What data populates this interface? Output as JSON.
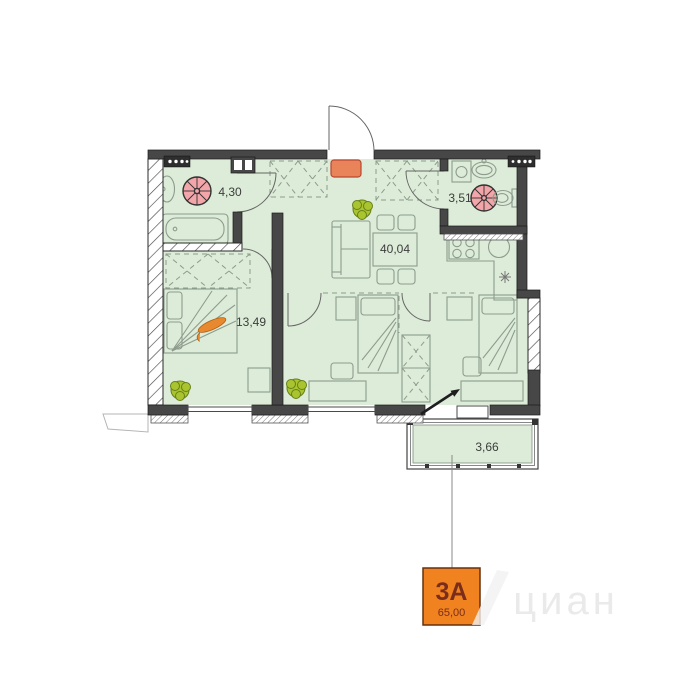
{
  "plan": {
    "unit": {
      "label": "3А",
      "area": "65,00"
    },
    "rooms": [
      {
        "id": "bathroom",
        "area": "4,30"
      },
      {
        "id": "wc",
        "area": "3,51"
      },
      {
        "id": "living-kitchen",
        "area": "40,04"
      },
      {
        "id": "bedroom",
        "area": "13,49"
      },
      {
        "id": "balcony",
        "area": "3,66"
      }
    ],
    "watermark": "циан",
    "colors": {
      "floor_fill": "#dcecd8",
      "wall_dark": "#474747",
      "line_gray": "#8d9c8d",
      "door_gray": "#666666",
      "accent_orange": "#f0831f",
      "unit_text": "#7b2d1b",
      "fan_pink": "#f2a6aa",
      "plant_green": "#a9c42e",
      "rug_orange": "#e8835a",
      "label_text": "#3d3d3d",
      "watermark_gray": "#eaeaea"
    }
  }
}
